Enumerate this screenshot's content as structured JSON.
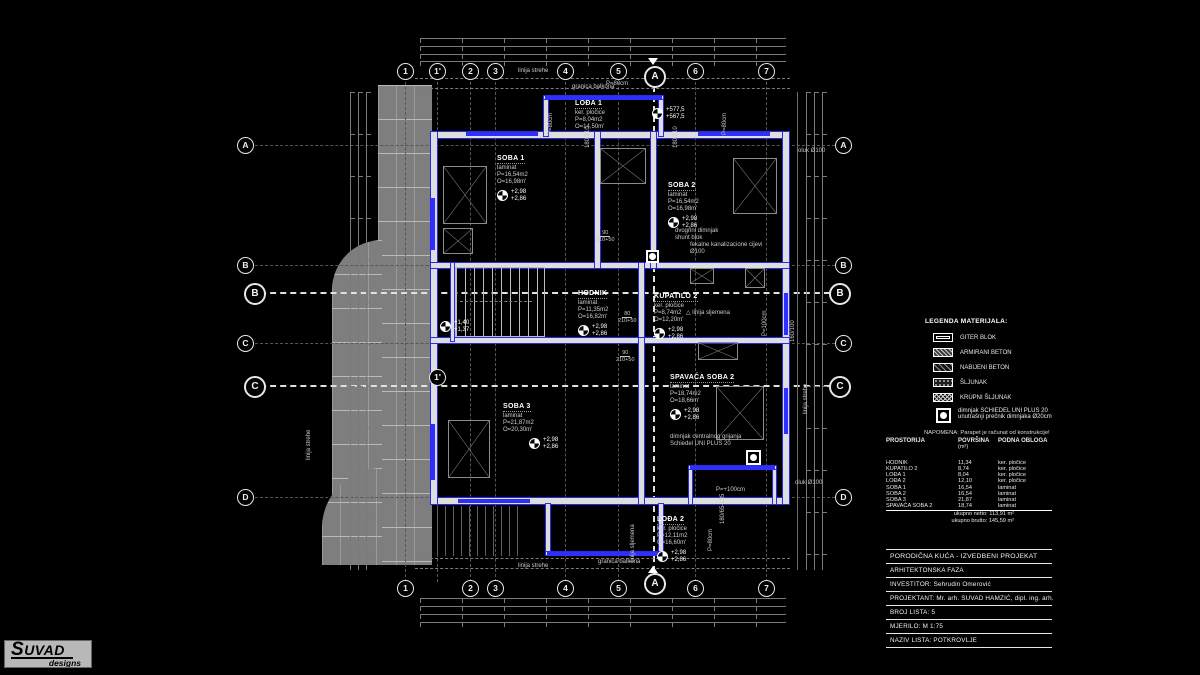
{
  "logo": {
    "title": "SUVAD",
    "subtitle": "designs"
  },
  "grid": {
    "top": [
      "1",
      "1'",
      "2",
      "3",
      "4",
      "5",
      "6",
      "7"
    ],
    "bottom": [
      "1",
      "2",
      "3",
      "4",
      "5",
      "6",
      "7"
    ],
    "left": [
      "A",
      "B",
      "C",
      "D"
    ],
    "right": [
      "A",
      "B",
      "C",
      "D"
    ],
    "section": {
      "a": "A",
      "b": "B",
      "c": "C",
      "one_prime": "1'"
    }
  },
  "plan": {
    "rooms": [
      {
        "name": "SOBA 1",
        "sub": [
          "laminat",
          "P=16,54m2",
          "O=16,98m'"
        ],
        "elev": [
          "+2,98",
          "+2,86"
        ]
      },
      {
        "name": "LOĐA 1",
        "sub": [
          "ker. pločice",
          "P=8,04m2",
          "O=14,50m'"
        ],
        "elev": []
      },
      {
        "name": "SOBA 2",
        "sub": [
          "laminat",
          "P=16,54m2",
          "O=16,98m'"
        ],
        "elev": [
          "+2,98",
          "+2,86"
        ]
      },
      {
        "name": "HODNIK",
        "sub": [
          "laminat",
          "P=11,35m2",
          "O=16,82m'"
        ],
        "elev": [
          "+2,98",
          "+2,86"
        ]
      },
      {
        "name": "KUPATILO 2",
        "sub": [
          "ker. pločice",
          "P=8,74m2",
          "O=12,20m'"
        ],
        "elev": [
          "+2,98",
          "+2,86"
        ]
      },
      {
        "name": "SOBA 3",
        "sub": [
          "laminat",
          "P=21,87m2",
          "O=20,30m'"
        ],
        "elev": [
          "+2,98",
          "+2,86"
        ]
      },
      {
        "name": "SPAVAĆA SOBA 2",
        "sub": [
          "laminat",
          "P=18,74m2",
          "O=18,66m'"
        ],
        "elev": [
          "+2,98",
          "+2,86"
        ]
      },
      {
        "name": "LOĐA 2",
        "sub": [
          "ker. pločice",
          "P=12,11m2",
          "O=16,60m'"
        ],
        "elev": [
          "+2,98",
          "+2,86"
        ]
      }
    ],
    "callouts": {
      "spot_elev_hi": [
        "+577,5",
        "+567,5"
      ],
      "stair_elev": [
        "+1,40",
        "+1,37"
      ],
      "chimney_shunt": [
        "dvogrlni dimnjak",
        "shunt blok"
      ],
      "sewer": [
        "fekalne kanalizacione cijevi",
        "Ø100"
      ],
      "ridge_line": "linija sljemena",
      "chimney_heating": [
        "dimnjak centralnog grijanja",
        "Schiedel UNI PLUS 20"
      ],
      "gutter": "oluk Ø100",
      "parapet_80": "P=80cm",
      "parapet_100v": "P=100cm",
      "parapet_100h": "P=+100cm",
      "eaves_line": "linija strehe",
      "balcony_line": "granica balkona",
      "door_90": "90",
      "door_80": "80",
      "door_h": "210+50",
      "win_180_210": "180/210",
      "win_160_100": "160/100",
      "win_180_65": "180/65-135"
    }
  },
  "legend": {
    "title": "LEGENDA MATERIJALA:",
    "items": [
      "GITER BLOK",
      "ARMIRANI BETON",
      "NABIJENI BETON",
      "ŠLJUNAK",
      "KRUPNI ŠLJUNAK"
    ],
    "chimney": [
      "dimnjak SCHIEDEL UNI PLUS 20",
      "unutrašnji prečnik dimnjaka Ø20cm"
    ],
    "note": "NAPOMENA: Parapet je računat od konstrukcije!"
  },
  "area_table": {
    "headers": [
      "PROSTORIJA",
      "POVRŠINA",
      "PODNA OBLOGA"
    ],
    "header_sub": "(m²)",
    "rows": [
      [
        "HODNIK",
        "11,34",
        "ker. pločice"
      ],
      [
        "KUPATILO 2",
        "8,74",
        "ker. pločice"
      ],
      [
        "LOĐA 1",
        "8,04",
        "ker. pločice"
      ],
      [
        "LOĐA 2",
        "12,10",
        "ker. pločice"
      ],
      [
        "SOBA 1",
        "16,54",
        "laminat"
      ],
      [
        "SOBA 2",
        "16,54",
        "laminat"
      ],
      [
        "SOBA 3",
        "21,87",
        "laminat"
      ],
      [
        "SPAVAĆA SOBA 2",
        "18,74",
        "laminat"
      ]
    ],
    "total_net": "ukupno netto:  113,91 m²",
    "total_gross": "ukupno brutto:  145,59 m²"
  },
  "title_block": {
    "rows": [
      "PORODIČNA KUĆA  - IZVEDBENI PROJEKAT",
      "ARHITEKTONSKA FAZA",
      "INVESTITOR: Sehrudin Omerović",
      "PROJEKTANT: Mr. arh. SUVAD HAMZIĆ, dipl. ing. arh.",
      "BROJ LISTA: 5",
      "MJERILO:   M 1:75",
      "NAZIV LISTA:  POTKROVLJE"
    ]
  }
}
